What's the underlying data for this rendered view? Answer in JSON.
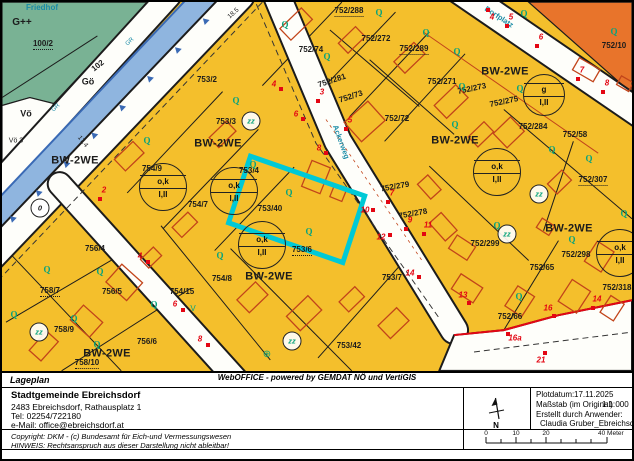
{
  "colors": {
    "parcel_yellow": "#F4BF2C",
    "parcel_orange": "#E8742B",
    "cemetery_green": "#79B294",
    "water_fill": "#8FB5DF",
    "water_edge": "#3A6AB5",
    "road_white": "#FEFEFA",
    "line_black": "#1C1C1C",
    "building_red": "#C2441A",
    "point_red": "#E30613",
    "symbol_teal": "#0AA37C",
    "street_name_teal": "#1B8CA6",
    "highlight_cyan": "#00C9D6"
  },
  "map": {
    "highlight_parcel": "753/40",
    "zone_text": "BW-2WE",
    "zone_positions": [
      [
        73,
        159
      ],
      [
        216,
        142
      ],
      [
        453,
        139
      ],
      [
        503,
        70
      ],
      [
        567,
        227
      ],
      [
        267,
        275
      ],
      [
        105,
        352
      ]
    ],
    "parcel_labels": [
      {
        "t": "100/2",
        "x": 41,
        "y": 43,
        "u": 1
      },
      {
        "t": "102",
        "x": 96,
        "y": 64,
        "r": -38
      },
      {
        "t": "753/2",
        "x": 205,
        "y": 78
      },
      {
        "t": "753/3",
        "x": 224,
        "y": 120
      },
      {
        "t": "753/4",
        "x": 247,
        "y": 169
      },
      {
        "t": "753/40",
        "x": 268,
        "y": 207
      },
      {
        "t": "753/6",
        "x": 300,
        "y": 249,
        "u": 1
      },
      {
        "t": "753/7",
        "x": 390,
        "y": 276
      },
      {
        "t": "753/42",
        "x": 347,
        "y": 344
      },
      {
        "t": "754/9",
        "x": 150,
        "y": 167
      },
      {
        "t": "754/7",
        "x": 196,
        "y": 203
      },
      {
        "t": "754/8",
        "x": 220,
        "y": 277
      },
      {
        "t": "754/15",
        "x": 180,
        "y": 290
      },
      {
        "t": "756/4",
        "x": 93,
        "y": 247
      },
      {
        "t": "756/5",
        "x": 110,
        "y": 290
      },
      {
        "t": "756/6",
        "x": 145,
        "y": 340
      },
      {
        "t": "758/7",
        "x": 48,
        "y": 290,
        "u": 1
      },
      {
        "t": "758/9",
        "x": 62,
        "y": 328
      },
      {
        "t": "758/10",
        "x": 85,
        "y": 362,
        "u": 1
      },
      {
        "t": "752/288",
        "x": 347,
        "y": 10,
        "u": 1
      },
      {
        "t": "752/74",
        "x": 309,
        "y": 48
      },
      {
        "t": "752/272",
        "x": 374,
        "y": 37
      },
      {
        "t": "752/289",
        "x": 412,
        "y": 48,
        "u": 1
      },
      {
        "t": "752/281",
        "x": 330,
        "y": 79,
        "r": -18
      },
      {
        "t": "752/73",
        "x": 349,
        "y": 95,
        "r": -18
      },
      {
        "t": "752/72",
        "x": 395,
        "y": 117
      },
      {
        "t": "752/271",
        "x": 440,
        "y": 80
      },
      {
        "t": "752/273",
        "x": 470,
        "y": 87,
        "r": -12
      },
      {
        "t": "752/275",
        "x": 502,
        "y": 100,
        "r": -12
      },
      {
        "t": "752/284",
        "x": 531,
        "y": 125
      },
      {
        "t": "752/10",
        "x": 612,
        "y": 44
      },
      {
        "t": "752/58",
        "x": 573,
        "y": 133
      },
      {
        "t": "752/307",
        "x": 591,
        "y": 179,
        "u": 1
      },
      {
        "t": "752/279",
        "x": 393,
        "y": 185,
        "r": -10
      },
      {
        "t": "752/278",
        "x": 411,
        "y": 212,
        "r": -10
      },
      {
        "t": "752/299",
        "x": 483,
        "y": 242
      },
      {
        "t": "752/298",
        "x": 574,
        "y": 253
      },
      {
        "t": "752/65",
        "x": 540,
        "y": 266
      },
      {
        "t": "752/66",
        "x": 508,
        "y": 315
      },
      {
        "t": "752/318",
        "x": 615,
        "y": 286
      }
    ],
    "street_names": [
      {
        "t": "Ackerweg",
        "x": 339,
        "y": 140,
        "r": 70,
        "fs": 7.5
      },
      {
        "t": "Dorfplatz",
        "x": 497,
        "y": 15,
        "r": 33,
        "fs": 7.5
      }
    ],
    "q_glyph": "Q",
    "q_positions": [
      [
        283,
        23
      ],
      [
        325,
        55
      ],
      [
        234,
        99
      ],
      [
        377,
        11
      ],
      [
        424,
        31
      ],
      [
        455,
        50
      ],
      [
        522,
        12
      ],
      [
        612,
        30
      ],
      [
        460,
        85
      ],
      [
        518,
        87
      ],
      [
        550,
        148
      ],
      [
        587,
        157
      ],
      [
        622,
        212
      ],
      [
        570,
        238
      ],
      [
        453,
        123
      ],
      [
        495,
        224
      ],
      [
        145,
        139
      ],
      [
        251,
        163
      ],
      [
        287,
        191
      ],
      [
        218,
        254
      ],
      [
        307,
        230
      ],
      [
        517,
        295
      ],
      [
        45,
        268
      ],
      [
        98,
        270
      ],
      [
        12,
        313
      ],
      [
        72,
        317
      ],
      [
        152,
        303
      ],
      [
        95,
        343
      ]
    ],
    "red_points": [
      {
        "n": "4",
        "x": 486,
        "y": 8,
        "dy": 7
      },
      {
        "n": "5",
        "x": 505,
        "y": 24
      },
      {
        "n": "6",
        "x": 535,
        "y": 44
      },
      {
        "n": "7",
        "x": 576,
        "y": 77
      },
      {
        "n": "8",
        "x": 601,
        "y": 90
      },
      {
        "n": "4",
        "x": 279,
        "y": 87,
        "dx": -7,
        "dy": -5
      },
      {
        "n": "3",
        "x": 316,
        "y": 99
      },
      {
        "n": "6",
        "x": 301,
        "y": 117,
        "dx": -7,
        "dy": -5
      },
      {
        "n": "5",
        "x": 344,
        "y": 127
      },
      {
        "n": "8",
        "x": 324,
        "y": 151,
        "dx": -7,
        "dy": -5
      },
      {
        "n": "7",
        "x": 386,
        "y": 200
      },
      {
        "n": "10",
        "x": 371,
        "y": 208,
        "dx": -8,
        "dy": 0
      },
      {
        "n": "9",
        "x": 404,
        "y": 227
      },
      {
        "n": "12",
        "x": 388,
        "y": 233,
        "dx": -9,
        "dy": 2
      },
      {
        "n": "11",
        "x": 422,
        "y": 232
      },
      {
        "n": "14",
        "x": 417,
        "y": 275,
        "dx": -9,
        "dy": -4
      },
      {
        "n": "13",
        "x": 467,
        "y": 301,
        "dx": -6,
        "dy": -8
      },
      {
        "n": "16",
        "x": 552,
        "y": 314,
        "dx": -6,
        "dy": -8
      },
      {
        "n": "14",
        "x": 591,
        "y": 306
      },
      {
        "n": "16a",
        "x": 506,
        "y": 332,
        "dx": 7,
        "dy": 4
      },
      {
        "n": "21",
        "x": 543,
        "y": 351,
        "dx": -4,
        "dy": 7
      },
      {
        "n": "2",
        "x": 98,
        "y": 197
      },
      {
        "n": "4",
        "x": 146,
        "y": 260,
        "dx": -8,
        "dy": -6
      },
      {
        "n": "6",
        "x": 181,
        "y": 308,
        "dx": -8,
        "dy": -6
      },
      {
        "n": "8",
        "x": 206,
        "y": 343,
        "dx": -8,
        "dy": -6
      }
    ],
    "ok_circles": [
      {
        "x": 161,
        "y": 185,
        "top": "o,k",
        "bottom": "I,II",
        "d": 46
      },
      {
        "x": 232,
        "y": 189,
        "top": "o,k",
        "bottom": "I,II",
        "d": 46
      },
      {
        "x": 260,
        "y": 243,
        "top": "o,k",
        "bottom": "I,II",
        "d": 46
      },
      {
        "x": 495,
        "y": 170,
        "top": "o,k",
        "bottom": "I,II",
        "d": 46
      },
      {
        "x": 618,
        "y": 251,
        "top": "o,k",
        "bottom": "I,II",
        "d": 46
      },
      {
        "x": 542,
        "y": 93,
        "top": "g",
        "bottom": "I,II",
        "d": 40
      }
    ],
    "circle_symbols": [
      {
        "t": "zz",
        "x": 249,
        "y": 119
      },
      {
        "t": "zz",
        "x": 537,
        "y": 192
      },
      {
        "t": "zz",
        "x": 505,
        "y": 232
      },
      {
        "t": "zz",
        "x": 37,
        "y": 330
      },
      {
        "t": "zz",
        "x": 290,
        "y": 339
      },
      {
        "t": "0",
        "x": 38,
        "y": 206,
        "c": "#222222"
      }
    ],
    "misc_labels": [
      {
        "t": "Friedhof",
        "x": 40,
        "y": 6,
        "c": "#1B8CA6",
        "fs": 8,
        "b": 1
      },
      {
        "t": "G++",
        "x": 20,
        "y": 21,
        "fs": 10,
        "b": 1
      },
      {
        "t": "Gö",
        "x": 86,
        "y": 80,
        "fs": 9,
        "b": 1
      },
      {
        "t": "Vö",
        "x": 24,
        "y": 112,
        "fs": 9,
        "b": 1
      },
      {
        "t": "Vö 3",
        "x": 14,
        "y": 139,
        "fs": 7
      },
      {
        "t": "GR",
        "x": 54,
        "y": 106,
        "r": -42,
        "fs": 6,
        "c": "#1B8CA6"
      },
      {
        "t": "GR",
        "x": 128,
        "y": 40,
        "r": -42,
        "fs": 6,
        "c": "#1B8CA6"
      },
      {
        "t": "18.5",
        "x": 232,
        "y": 12,
        "r": -42,
        "fs": 6.5
      },
      {
        "t": "17.4",
        "x": 80,
        "y": 140,
        "r": 52,
        "fs": 6.5
      },
      {
        "t": "V",
        "x": 191,
        "y": 307,
        "fs": 8,
        "c": "#0AA37C"
      },
      {
        "t": "⊕",
        "x": 265,
        "y": 353,
        "fs": 10,
        "c": "#0AA37C"
      }
    ]
  },
  "footer": {
    "title": "Lageplan",
    "org": {
      "name": "Stadtgemeinde Ebreichsdorf",
      "address": "2483 Ebreichsdorf, Rathausplatz 1",
      "tel": "Tel: 02254/722180",
      "email": "e-Mail: office@ebreichsdorf.at"
    },
    "copyright": "Copyright: DKM - (c) Bundesamt für Eich-und Vermessungswesen",
    "hinweis": "HINWEIS: Rechtsanspruch aus dieser Darstellung nicht ableitbar!",
    "plot": {
      "date_label": "Plotdatum:",
      "date": "17.11.2025",
      "scale_label": "Maßstab (im Original):",
      "scale": "1:1 000",
      "creator_label": "Erstellt durch Anwender:",
      "creator": "Claudia Gruber_Ebreichsdorf"
    },
    "north_label": "N",
    "scale_bar": {
      "labels": [
        "0",
        "10",
        "20",
        "40 Meter"
      ]
    },
    "app_credit": "WebOFFICE - powered by GEMDAT NÖ und VertiGIS"
  }
}
